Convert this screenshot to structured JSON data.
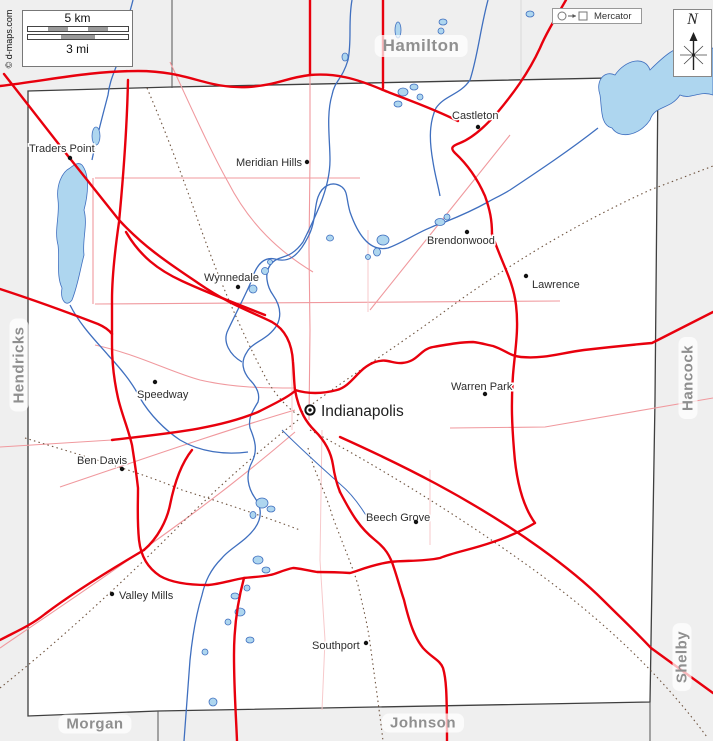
{
  "map": {
    "projection_label": "Mercator",
    "compass_label": "N",
    "attribution": "© d-maps.com",
    "scale": {
      "km_label": "5 km",
      "mi_label": "3 mi"
    }
  },
  "colors": {
    "road_major": "#e8000d",
    "road_minor": "#f0999e",
    "road_faint": "#f7c9cb",
    "railway": "#6f5440",
    "water_line": "#3f6fbf",
    "water_fill": "#aed6ef",
    "county_line": "#3f3f3f",
    "outside_fill": "#efefef",
    "county_label_color": "#8f8f8f"
  },
  "counties": [
    {
      "name": "Hamilton",
      "x": 421,
      "y": 46,
      "rotate": 0,
      "big": true
    },
    {
      "name": "Hendricks",
      "x": 19,
      "y": 365,
      "rotate": -90,
      "big": false
    },
    {
      "name": "Hancock",
      "x": 688,
      "y": 378,
      "rotate": -90,
      "big": false
    },
    {
      "name": "Shelby",
      "x": 682,
      "y": 657,
      "rotate": -90,
      "big": false
    },
    {
      "name": "Morgan",
      "x": 95,
      "y": 724,
      "rotate": 0,
      "big": false
    },
    {
      "name": "Johnson",
      "x": 423,
      "y": 723,
      "rotate": 0,
      "big": false
    }
  ],
  "capital": {
    "name": "Indianapolis",
    "dot_x": 310,
    "dot_y": 410,
    "label_x": 321,
    "label_y": 416
  },
  "cities": [
    {
      "name": "Traders Point",
      "dot_x": 70,
      "dot_y": 158,
      "label_x": 29,
      "label_y": 152
    },
    {
      "name": "Meridian Hills",
      "dot_x": 307,
      "dot_y": 162,
      "label_x": 236,
      "label_y": 166
    },
    {
      "name": "Castleton",
      "dot_x": 478,
      "dot_y": 127,
      "label_x": 452,
      "label_y": 119
    },
    {
      "name": "Brendonwood",
      "dot_x": 467,
      "dot_y": 232,
      "label_x": 427,
      "label_y": 244
    },
    {
      "name": "Lawrence",
      "dot_x": 526,
      "dot_y": 276,
      "label_x": 532,
      "label_y": 288
    },
    {
      "name": "Wynnedale",
      "dot_x": 238,
      "dot_y": 287,
      "label_x": 204,
      "label_y": 281
    },
    {
      "name": "Speedway",
      "dot_x": 155,
      "dot_y": 382,
      "label_x": 137,
      "label_y": 398
    },
    {
      "name": "Warren Park",
      "dot_x": 485,
      "dot_y": 394,
      "label_x": 451,
      "label_y": 390
    },
    {
      "name": "Ben Davis",
      "dot_x": 122,
      "dot_y": 469,
      "label_x": 77,
      "label_y": 464
    },
    {
      "name": "Beech Grove",
      "dot_x": 416,
      "dot_y": 522,
      "label_x": 366,
      "label_y": 521
    },
    {
      "name": "Valley Mills",
      "dot_x": 112,
      "dot_y": 594,
      "label_x": 119,
      "label_y": 599
    },
    {
      "name": "Southport",
      "dot_x": 366,
      "dot_y": 643,
      "label_x": 312,
      "label_y": 649
    }
  ]
}
